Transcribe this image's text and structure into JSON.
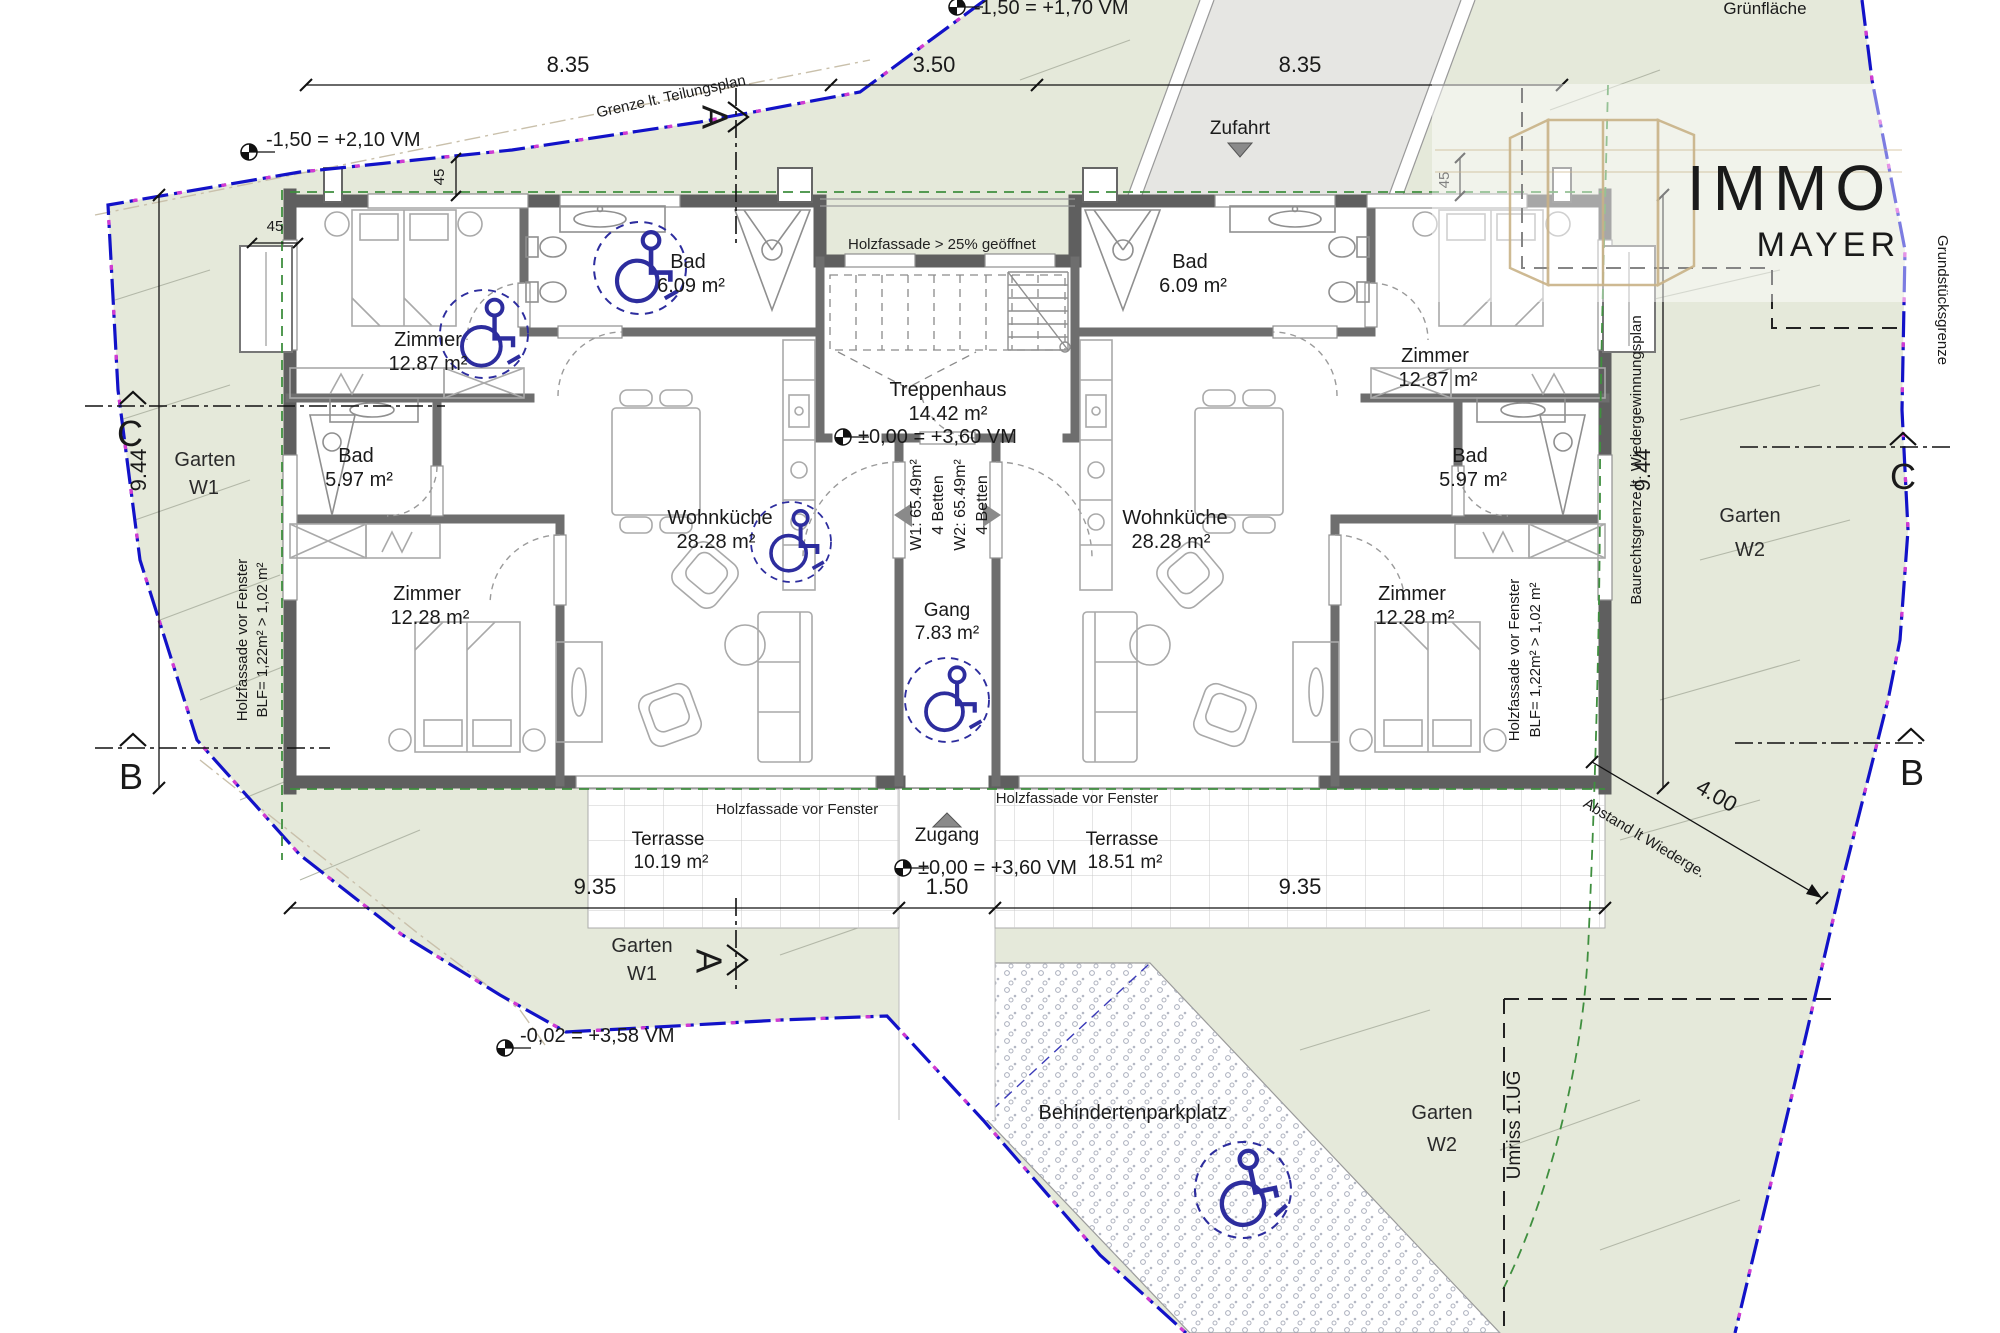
{
  "branding": {
    "immo": "IMMO",
    "mayer": "MAYER"
  },
  "site": {
    "gruenflaeche": "Grünfläche",
    "zufahrt": "Zufahrt",
    "zugang": "Zugang",
    "behindertenparkplatz": "Behindertenparkplatz",
    "umriss_ug": "Umriss 1.UG",
    "grenze_teilungsplan": "Grenze lt. Teilungsplan",
    "grundstuecksgrenze": "Grundstücksgrenze",
    "baurechtsgrenze": "Baurechtsgrenze lt. Wiedergewinnungsplan",
    "abstand": "Abstand lt Wiederge.",
    "gardens": {
      "w1_side": {
        "line1": "Garten",
        "line2": "W1"
      },
      "w1_bottom": {
        "line1": "Garten",
        "line2": "W1"
      },
      "w2_side": {
        "line1": "Garten",
        "line2": "W2"
      },
      "w2_bottom": {
        "line1": "Garten",
        "line2": "W2"
      }
    }
  },
  "elevations": {
    "top_left": "-1,50 = +2,10 VM",
    "top_mid": "-1,50 = +1,70 VM",
    "treppenhaus": "±0,00 = +3,60 VM",
    "zugang": "±0,00 = +3,60 VM",
    "bottom_left": "-0,02 = +3,58 VM"
  },
  "dims": {
    "top1": "8.35",
    "top2": "3.50",
    "top3": "8.35",
    "bottom1": "9.35",
    "bottom2": "1.50",
    "bottom3": "9.35",
    "left_v": "9.44",
    "right_v": "9.44",
    "diag": "4.00",
    "w45a": "45",
    "w45b": "45",
    "w45c": "45"
  },
  "sections": {
    "a_top": "A",
    "a_bottom": "A",
    "b_left": "B",
    "b_right": "B",
    "c_left": "C",
    "c_right": "C"
  },
  "units": {
    "w1": {
      "id": "W1: 65.49m²",
      "beds": "4 Betten",
      "rooms": {
        "zimmer1": {
          "name": "Zimmer",
          "area": "12.87 m²"
        },
        "bad1": {
          "name": "Bad",
          "area": "6.09 m²"
        },
        "bad2": {
          "name": "Bad",
          "area": "5.97 m²"
        },
        "zimmer2": {
          "name": "Zimmer",
          "area": "12.28 m²"
        },
        "wohnkueche": {
          "name": "Wohnküche",
          "area": "28.28 m²"
        },
        "terrasse": {
          "name": "Terrasse",
          "area": "10.19 m²"
        }
      }
    },
    "w2": {
      "id": "W2: 65.49m²",
      "beds": "4 Betten",
      "rooms": {
        "zimmer1": {
          "name": "Zimmer",
          "area": "12.87 m²"
        },
        "bad1": {
          "name": "Bad",
          "area": "6.09 m²"
        },
        "bad2": {
          "name": "Bad",
          "area": "5.97 m²"
        },
        "zimmer2": {
          "name": "Zimmer",
          "area": "12.28 m²"
        },
        "wohnkueche": {
          "name": "Wohnküche",
          "area": "28.28 m²"
        },
        "terrasse": {
          "name": "Terrasse",
          "area": "18.51 m²"
        }
      }
    },
    "shared": {
      "treppenhaus": {
        "name": "Treppenhaus",
        "area": "14.42 m²"
      },
      "gang": {
        "name": "Gang",
        "area": "7.83 m²"
      }
    }
  },
  "facade": {
    "open_note": "Holzfassade > 25% geöffnet",
    "front_w1": "Holzfassade vor Fenster",
    "front_w2": "Holzfassade vor Fenster",
    "side_left_1": "Holzfassade vor Fenster",
    "side_left_2": "BLF= 1,22m² > 1,02 m²",
    "side_right_1": "Holzfassade vor Fenster",
    "side_right_2": "BLF= 1,22m² > 1,02 m²"
  },
  "colors": {
    "garden_green": "#e5e9da",
    "boundary_blue": "#1212c8",
    "boundary_magenta": "#d23bd2",
    "facade_green_dash": "#3f8f3f",
    "accessibility_blue": "#2d2d9e",
    "label_blue": "#3a3ab8",
    "logo_gray": "#9b9b99",
    "logo_tan": "#c9b287",
    "wall_gray": "#5f5f5f",
    "driveway_gray": "#e6e6e3"
  }
}
